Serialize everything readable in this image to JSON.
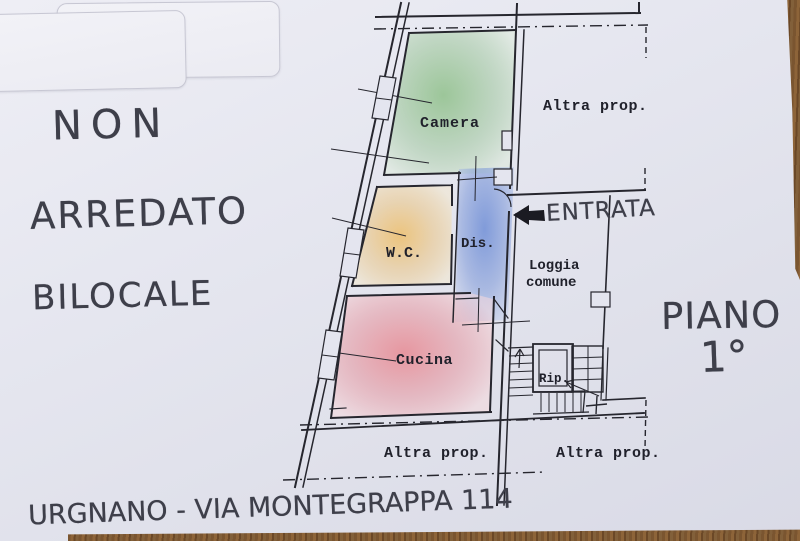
{
  "handwritten_notes": {
    "note_line1": "NON",
    "note_line2": "ARREDATO",
    "note_line3": "BILOCALE",
    "floor_word": "PIANO",
    "floor_number": "1°",
    "entrance": "ENTRATA",
    "address": "URGNANO - VIA MONTEGRAPPA 114"
  },
  "floorplan": {
    "rooms": [
      {
        "id": "camera",
        "label": "Camera",
        "fill_center": "#8fc08a",
        "fill_edge": "#dcead9"
      },
      {
        "id": "wc",
        "label": "W.C.",
        "fill_center": "#edbe6a",
        "fill_edge": "#f4e8cc"
      },
      {
        "id": "dis",
        "label": "Dis.",
        "fill_center": "#6f8ed6",
        "fill_edge": "#cdd6ee"
      },
      {
        "id": "cucina",
        "label": "Cucina",
        "fill_center": "#e8848d",
        "fill_edge": "#f7d9dc"
      },
      {
        "id": "loggia",
        "label_line1": "Loggia",
        "label_line2": "comune"
      },
      {
        "id": "rip",
        "label": "Rip."
      }
    ],
    "other_property_label_top": "Altra prop.",
    "other_property_label_bottom_left": "Altra prop.",
    "other_property_label_bottom_right": "Altra prop.",
    "ink_color": "#26262e",
    "pen_color": "#3e3f4a",
    "paper_color": "#e4e5ef",
    "wood_color": "#7a5530"
  }
}
